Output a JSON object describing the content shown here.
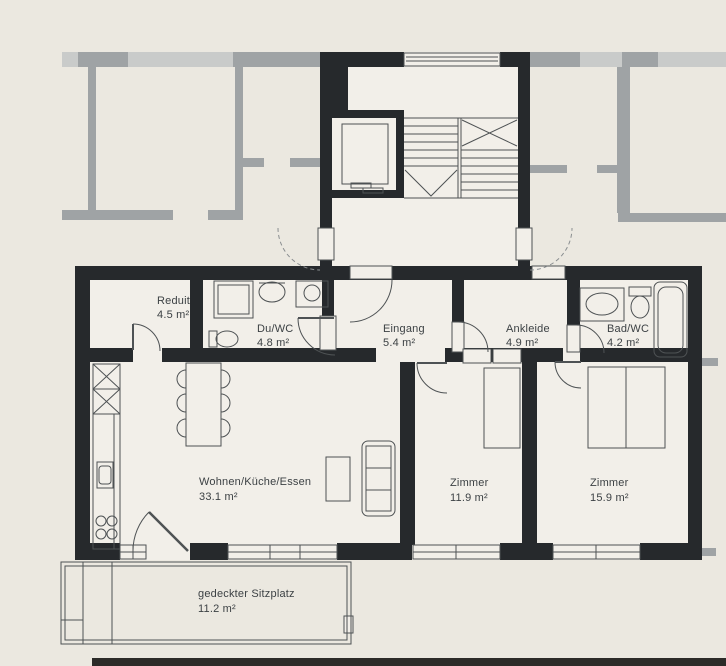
{
  "colors": {
    "background": "#ebe8e0",
    "interior": "#f2efe9",
    "wall": "#26292c",
    "neighbor_wall": "#9fa3a5",
    "neighbor_window": "#c9cbca",
    "line": "#4e5254",
    "dashed_line": "#8a8e90",
    "text": "#3c4144",
    "scan_edge": "#2c2b28"
  },
  "rooms": {
    "reduit": {
      "name": "Reduit",
      "area": "4.5 m²"
    },
    "du_wc": {
      "name": "Du/WC",
      "area": "4.8 m²"
    },
    "eingang": {
      "name": "Eingang",
      "area": "5.4 m²"
    },
    "ankleide": {
      "name": "Ankleide",
      "area": "4.9 m²"
    },
    "bad_wc": {
      "name": "Bad/WC",
      "area": "4.2 m²"
    },
    "wohnen": {
      "name": "Wohnen/Küche/Essen",
      "area": "33.1 m²"
    },
    "zimmer1": {
      "name": "Zimmer",
      "area": "11.9 m²"
    },
    "zimmer2": {
      "name": "Zimmer",
      "area": "15.9 m²"
    },
    "sitzplatz": {
      "name": "gedeckter Sitzplatz",
      "area": "11.2 m²"
    }
  }
}
